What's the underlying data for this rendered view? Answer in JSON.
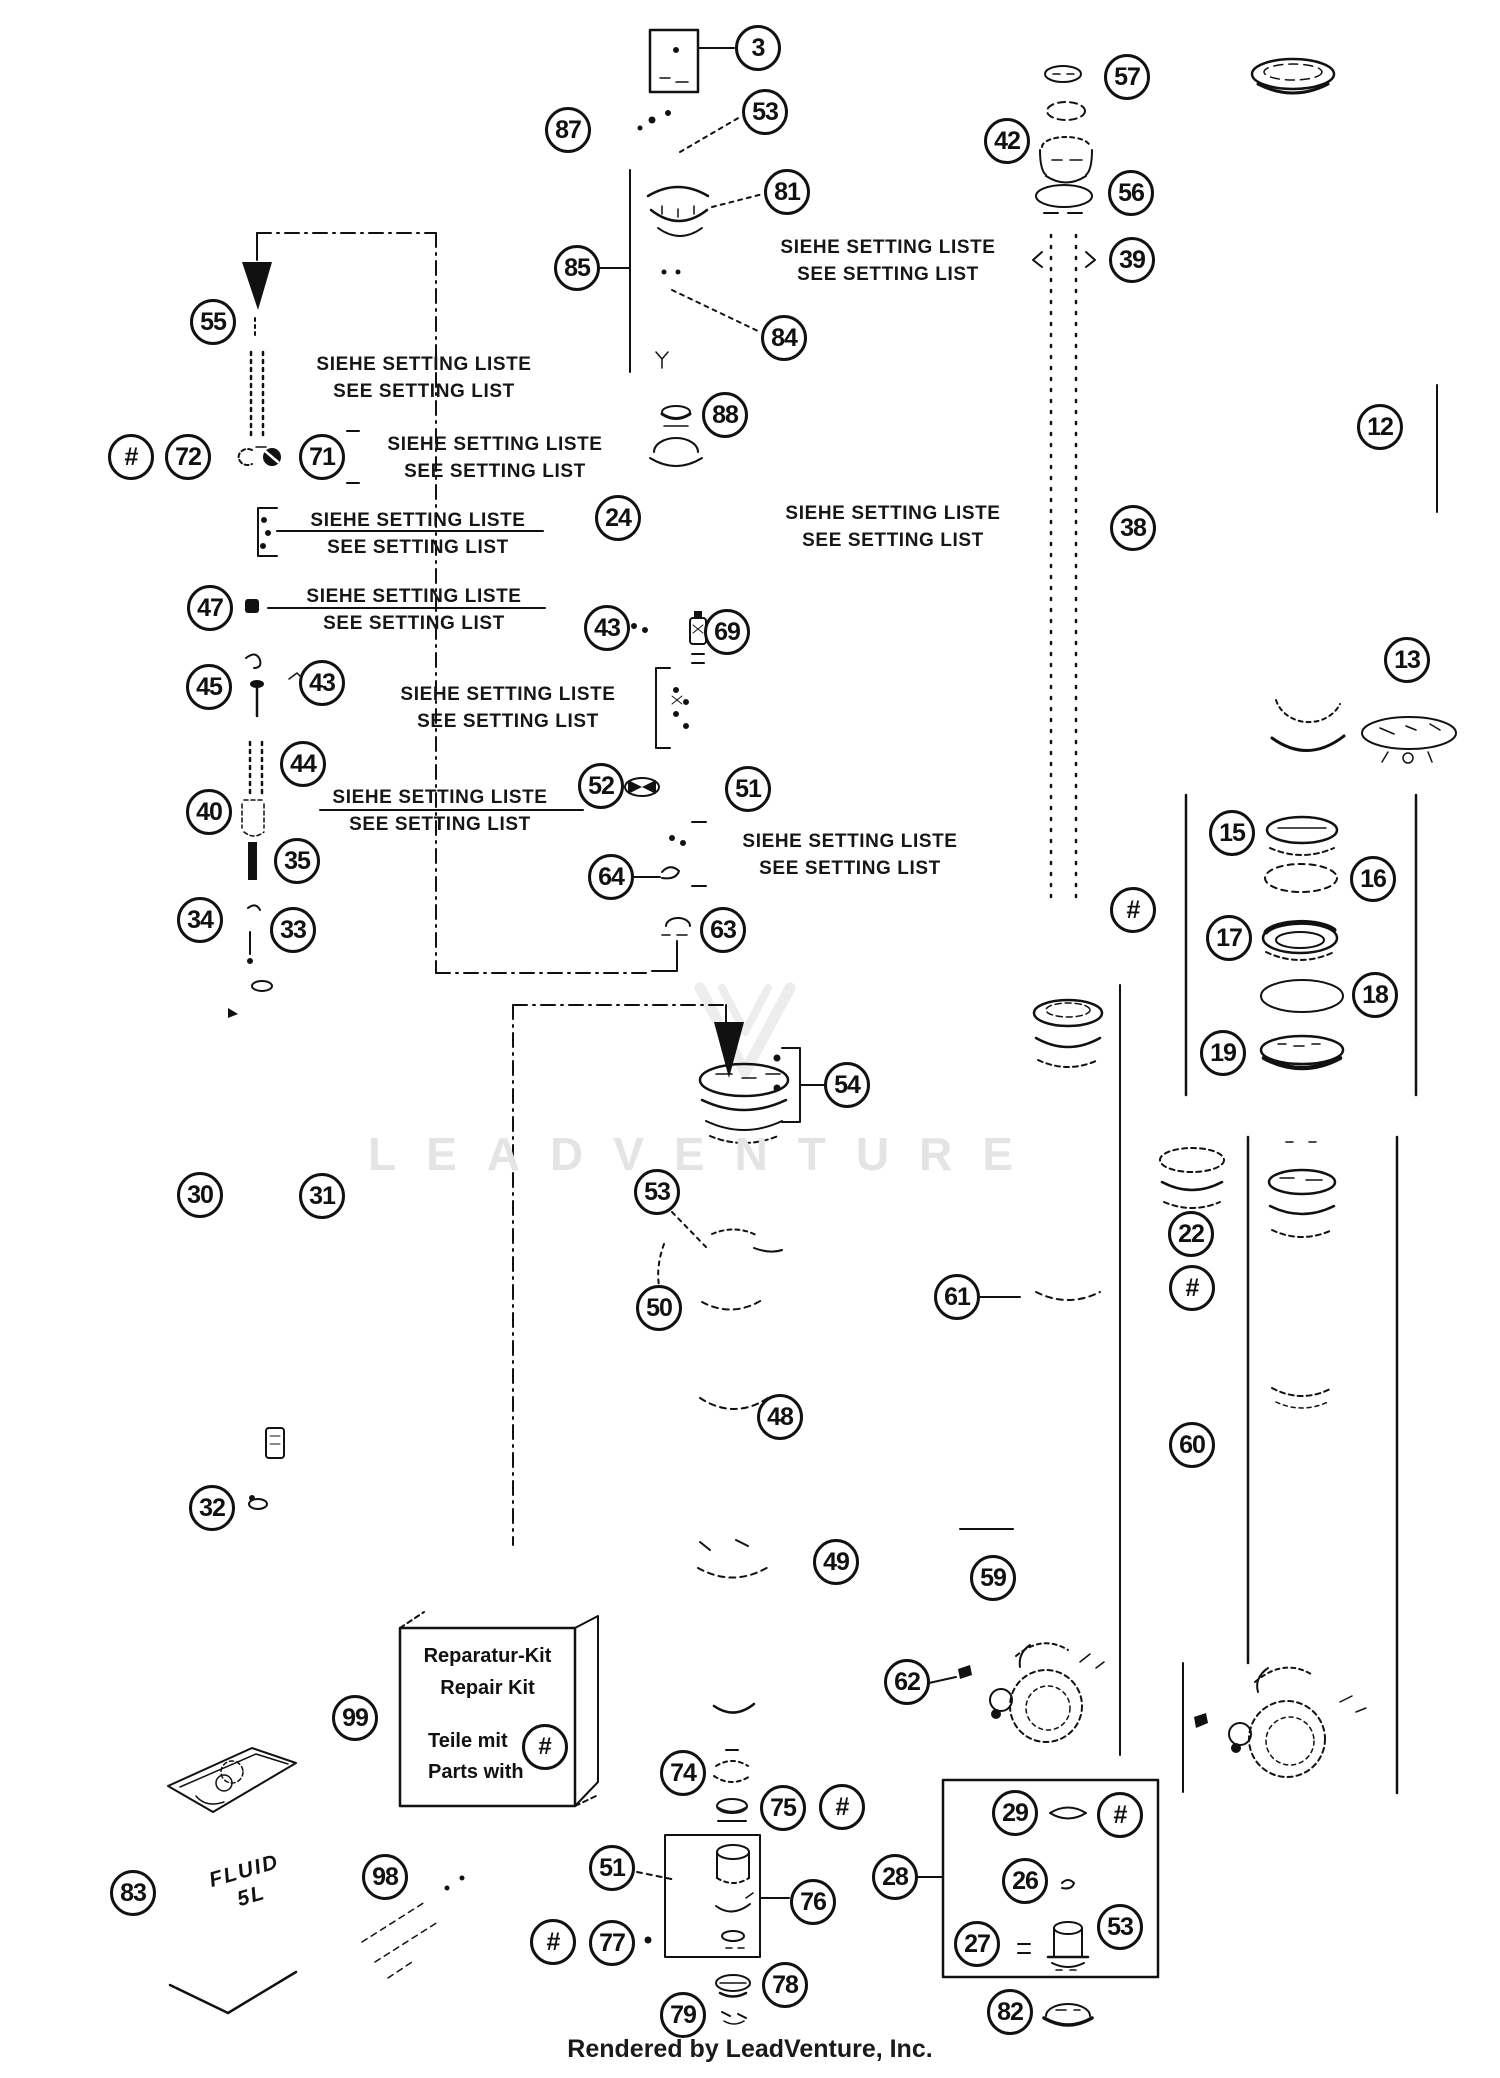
{
  "colors": {
    "ink": "#111111",
    "watermark": "#e4e4e4",
    "background": "#ffffff"
  },
  "watermark": {
    "text": "LEADVENTURE"
  },
  "footer": {
    "credit": "Rendered by LeadVenture, Inc."
  },
  "repair_kit_box": {
    "title_de": "Reparatur-Kit",
    "title_en": "Repair Kit",
    "note_de": "Teile mit",
    "note_en": "Parts with",
    "hash": "#"
  },
  "fluid_label": {
    "line1": "FLUID",
    "line2": "5L"
  },
  "setting_notes": [
    {
      "de": "SIEHE SETTING LISTE",
      "en": "SEE SETTING LIST",
      "x": 424,
      "y": 351
    },
    {
      "de": "SIEHE SETTING LISTE",
      "en": "SEE SETTING LIST",
      "x": 495,
      "y": 431
    },
    {
      "de": "SIEHE SETTING LISTE",
      "en": "SEE SETTING LIST",
      "x": 418,
      "y": 507
    },
    {
      "de": "SIEHE SETTING LISTE",
      "en": "SEE SETTING LIST",
      "x": 414,
      "y": 583
    },
    {
      "de": "SIEHE SETTING LISTE",
      "en": "SEE SETTING LIST",
      "x": 508,
      "y": 681
    },
    {
      "de": "SIEHE SETTING LISTE",
      "en": "SEE SETTING LIST",
      "x": 440,
      "y": 784
    },
    {
      "de": "SIEHE SETTING LISTE",
      "en": "SEE SETTING LIST",
      "x": 850,
      "y": 828
    },
    {
      "de": "SIEHE SETTING LISTE",
      "en": "SEE SETTING LIST",
      "x": 888,
      "y": 234
    },
    {
      "de": "SIEHE SETTING LISTE",
      "en": "SEE SETTING LIST",
      "x": 893,
      "y": 500
    }
  ],
  "callouts": [
    {
      "label": "3",
      "x": 758,
      "y": 48
    },
    {
      "label": "53",
      "x": 765,
      "y": 112
    },
    {
      "label": "87",
      "x": 568,
      "y": 130
    },
    {
      "label": "81",
      "x": 787,
      "y": 192
    },
    {
      "label": "85",
      "x": 577,
      "y": 268
    },
    {
      "label": "84",
      "x": 784,
      "y": 338
    },
    {
      "label": "88",
      "x": 725,
      "y": 415
    },
    {
      "label": "57",
      "x": 1127,
      "y": 77
    },
    {
      "label": "42",
      "x": 1007,
      "y": 141
    },
    {
      "label": "56",
      "x": 1131,
      "y": 193
    },
    {
      "label": "39",
      "x": 1132,
      "y": 260
    },
    {
      "label": "12",
      "x": 1380,
      "y": 427
    },
    {
      "label": "38",
      "x": 1133,
      "y": 528
    },
    {
      "label": "13",
      "x": 1407,
      "y": 660
    },
    {
      "label": "55",
      "x": 213,
      "y": 322
    },
    {
      "label": "#",
      "x": 131,
      "y": 457
    },
    {
      "label": "72",
      "x": 188,
      "y": 457
    },
    {
      "label": "71",
      "x": 322,
      "y": 457
    },
    {
      "label": "24",
      "x": 618,
      "y": 518
    },
    {
      "label": "47",
      "x": 210,
      "y": 608
    },
    {
      "label": "45",
      "x": 209,
      "y": 687
    },
    {
      "label": "43",
      "x": 322,
      "y": 683
    },
    {
      "label": "43",
      "x": 607,
      "y": 628
    },
    {
      "label": "69",
      "x": 727,
      "y": 632
    },
    {
      "label": "44",
      "x": 303,
      "y": 764
    },
    {
      "label": "40",
      "x": 209,
      "y": 812
    },
    {
      "label": "52",
      "x": 601,
      "y": 786
    },
    {
      "label": "51",
      "x": 748,
      "y": 789
    },
    {
      "label": "35",
      "x": 297,
      "y": 861
    },
    {
      "label": "64",
      "x": 611,
      "y": 877
    },
    {
      "label": "34",
      "x": 200,
      "y": 920
    },
    {
      "label": "33",
      "x": 293,
      "y": 930
    },
    {
      "label": "63",
      "x": 723,
      "y": 930
    },
    {
      "label": "#",
      "x": 1133,
      "y": 910
    },
    {
      "label": "15",
      "x": 1232,
      "y": 833
    },
    {
      "label": "16",
      "x": 1373,
      "y": 879
    },
    {
      "label": "17",
      "x": 1229,
      "y": 938
    },
    {
      "label": "18",
      "x": 1375,
      "y": 995
    },
    {
      "label": "19",
      "x": 1223,
      "y": 1053
    },
    {
      "label": "54",
      "x": 847,
      "y": 1085
    },
    {
      "label": "30",
      "x": 200,
      "y": 1195
    },
    {
      "label": "31",
      "x": 322,
      "y": 1196
    },
    {
      "label": "53",
      "x": 657,
      "y": 1192
    },
    {
      "label": "50",
      "x": 659,
      "y": 1308
    },
    {
      "label": "61",
      "x": 957,
      "y": 1297
    },
    {
      "label": "22",
      "x": 1191,
      "y": 1234
    },
    {
      "label": "#",
      "x": 1192,
      "y": 1288
    },
    {
      "label": "48",
      "x": 780,
      "y": 1417
    },
    {
      "label": "60",
      "x": 1192,
      "y": 1445
    },
    {
      "label": "32",
      "x": 212,
      "y": 1508
    },
    {
      "label": "49",
      "x": 836,
      "y": 1562
    },
    {
      "label": "59",
      "x": 993,
      "y": 1578
    },
    {
      "label": "62",
      "x": 907,
      "y": 1682
    },
    {
      "label": "99",
      "x": 355,
      "y": 1718
    },
    {
      "label": "74",
      "x": 683,
      "y": 1773
    },
    {
      "label": "75",
      "x": 783,
      "y": 1808
    },
    {
      "label": "#",
      "x": 842,
      "y": 1807
    },
    {
      "label": "51",
      "x": 612,
      "y": 1868
    },
    {
      "label": "28",
      "x": 895,
      "y": 1877
    },
    {
      "label": "76",
      "x": 813,
      "y": 1902
    },
    {
      "label": "#",
      "x": 553,
      "y": 1942
    },
    {
      "label": "77",
      "x": 612,
      "y": 1943
    },
    {
      "label": "78",
      "x": 785,
      "y": 1985
    },
    {
      "label": "79",
      "x": 683,
      "y": 2015
    },
    {
      "label": "83",
      "x": 133,
      "y": 1893
    },
    {
      "label": "98",
      "x": 385,
      "y": 1877
    },
    {
      "label": "29",
      "x": 1015,
      "y": 1813
    },
    {
      "label": "#",
      "x": 1120,
      "y": 1815
    },
    {
      "label": "26",
      "x": 1025,
      "y": 1881
    },
    {
      "label": "27",
      "x": 977,
      "y": 1944
    },
    {
      "label": "53",
      "x": 1120,
      "y": 1927
    },
    {
      "label": "82",
      "x": 1010,
      "y": 2012
    }
  ]
}
